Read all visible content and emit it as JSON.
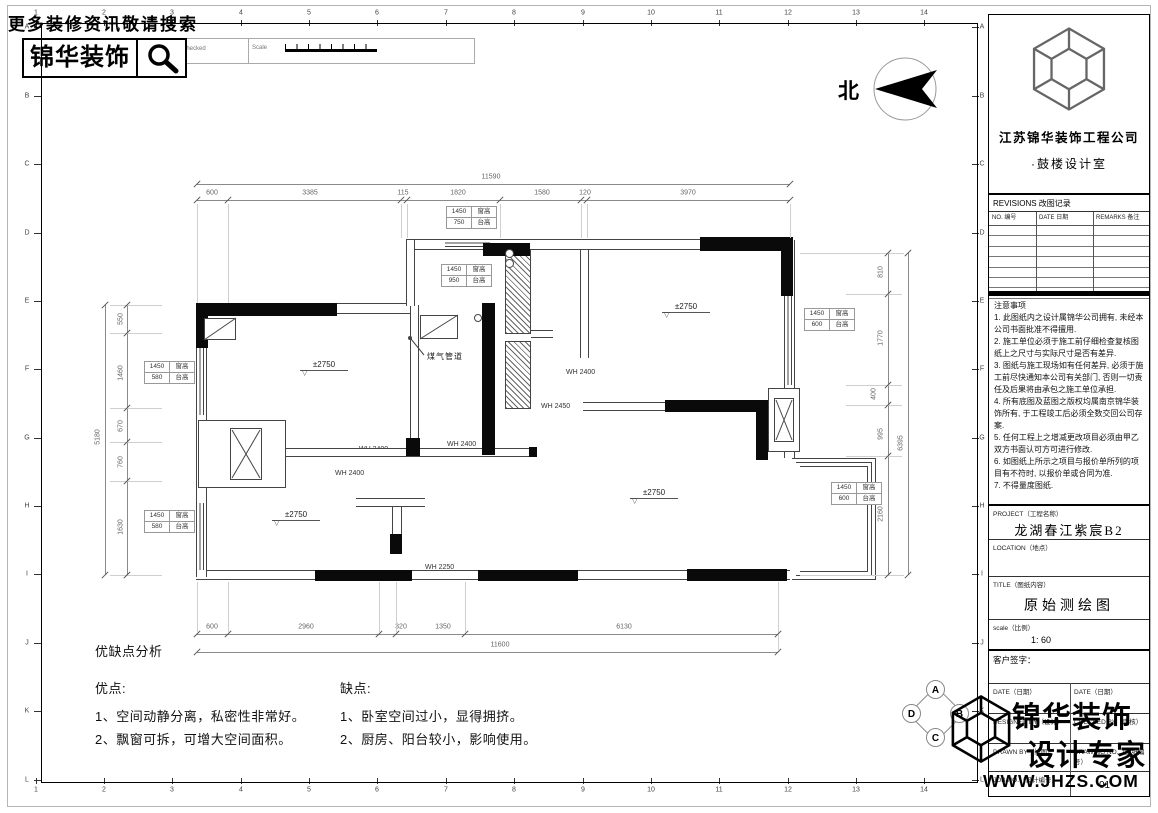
{
  "header": {
    "search_hint": "更多装修资讯敬请搜索",
    "logo_text": "锦华装饰",
    "strip": {
      "rev_no": "RevNo",
      "revision_note": "Revision note",
      "signature": "Signature",
      "checked": "Checked",
      "scale": "Scale"
    }
  },
  "grid": {
    "columns": [
      "1",
      "2",
      "3",
      "4",
      "5",
      "6",
      "7",
      "8",
      "9",
      "10",
      "11",
      "12",
      "13",
      "14"
    ],
    "rows": [
      "A",
      "B",
      "C",
      "D",
      "E",
      "F",
      "G",
      "H",
      "I",
      "J",
      "K",
      "L"
    ]
  },
  "north_label": "北",
  "plan": {
    "dims": {
      "top_overall": "11590",
      "top_segments": [
        "600",
        "3385",
        "115",
        "1820",
        "1580",
        "120",
        "3970"
      ],
      "bottom_segments": [
        "600",
        "2960",
        "320",
        "1350",
        "6130"
      ],
      "bottom_overall": "11600",
      "left_overall": "5180",
      "left_segments": [
        "550",
        "1460",
        "670",
        "760",
        "1630"
      ],
      "right_segments": [
        "810",
        "1770",
        "400",
        "995",
        "2160"
      ],
      "right_overall": "6395"
    },
    "levels": [
      "±2750",
      "±2750",
      "±2750",
      "±2750"
    ],
    "wh_labels": [
      "WH 2400",
      "WH 2450",
      "WH 2400",
      "WH 2400",
      "WH 2400",
      "WH 2250"
    ],
    "gas_label": "煤气管道",
    "flue_labels": [
      "H=-240",
      "H=-240"
    ],
    "callouts": [
      {
        "v1": "1450",
        "l1": "窗高",
        "v2": "750",
        "l2": "台高"
      },
      {
        "v1": "1450",
        "l1": "窗高",
        "v2": "950",
        "l2": "台高"
      },
      {
        "v1": "1450",
        "l1": "窗高",
        "v2": "600",
        "l2": "台高"
      },
      {
        "v1": "1450",
        "l1": "窗高",
        "v2": "600",
        "l2": "台高"
      },
      {
        "v1": "1450",
        "l1": "窗高",
        "v2": "580",
        "l2": "台高"
      },
      {
        "v1": "1450",
        "l1": "窗高",
        "v2": "580",
        "l2": "台高"
      }
    ],
    "elevation_symbol": [
      "A",
      "B",
      "C",
      "D"
    ]
  },
  "analysis": {
    "title": "优缺点分析",
    "pros_title": "优点:",
    "pros": [
      "1、空间动静分离，私密性非常好。",
      "2、飘窗可拆，可增大空间面积。"
    ],
    "cons_title": "缺点:",
    "cons": [
      "1、卧室空间过小，显得拥挤。",
      "2、厨房、阳台较小，影响使用。"
    ]
  },
  "titleblock": {
    "company": "江苏锦华装饰工程公司",
    "studio": "·鼓楼设计室",
    "revisions_header": "REVISIONS 改图记录",
    "rev_cols": [
      "NO. 编号",
      "DATE 日期",
      "REMARKS 备注"
    ],
    "notes_title": "注意事项",
    "notes": [
      "1. 此图纸内之设计属锦华公司拥有, 未经本公司书面批准不得擅用.",
      "2. 施工单位必须于施工前仔细检查复核图纸上之尺寸与实际尺寸是否有差异.",
      "3. 图纸与施工现场如有任何差异, 必须于施工前尽快通知本公司有关部门, 否则一切责任及后果将由承包之施工单位承担.",
      "4. 所有底图及蓝图之版权均属南京锦华装饰所有, 于工程竣工后必须全数交回公司存案.",
      "5. 任何工程上之增减更改项目必须由甲乙双方书面认可方可进行修改.",
      "6. 如图纸上所示之项目与报价单所列的项目有不符时, 以报价单或合同为准.",
      "7. 不得量度图纸."
    ],
    "project_label": "PROJECT（工程名称）",
    "project_value": "龙湖春江紫宸B2",
    "location_label": "LOCATION（地点）",
    "title_label": "TITLE（图纸内容）",
    "title_value": "原始测绘图",
    "scale_label": "scale（比例）",
    "scale_value": "1: 60",
    "client_sign": "客户签字：",
    "date_left": "DATE（日期）",
    "date_right": "DATE（日期）",
    "designed_by": "DESIGNED BY（设计）",
    "checked_by": "CHECKED BY（审核）",
    "drawn_by": "DRAWN BY（绘图）",
    "drawing_no": "DRAWING NO.（图纸编号）",
    "job_no": "JOB NO.（设计编号）",
    "sheet_no": "01"
  },
  "watermark": {
    "line1": "锦华装饰",
    "line2": "设计专家",
    "url": "WWW.JHZS.COM"
  }
}
